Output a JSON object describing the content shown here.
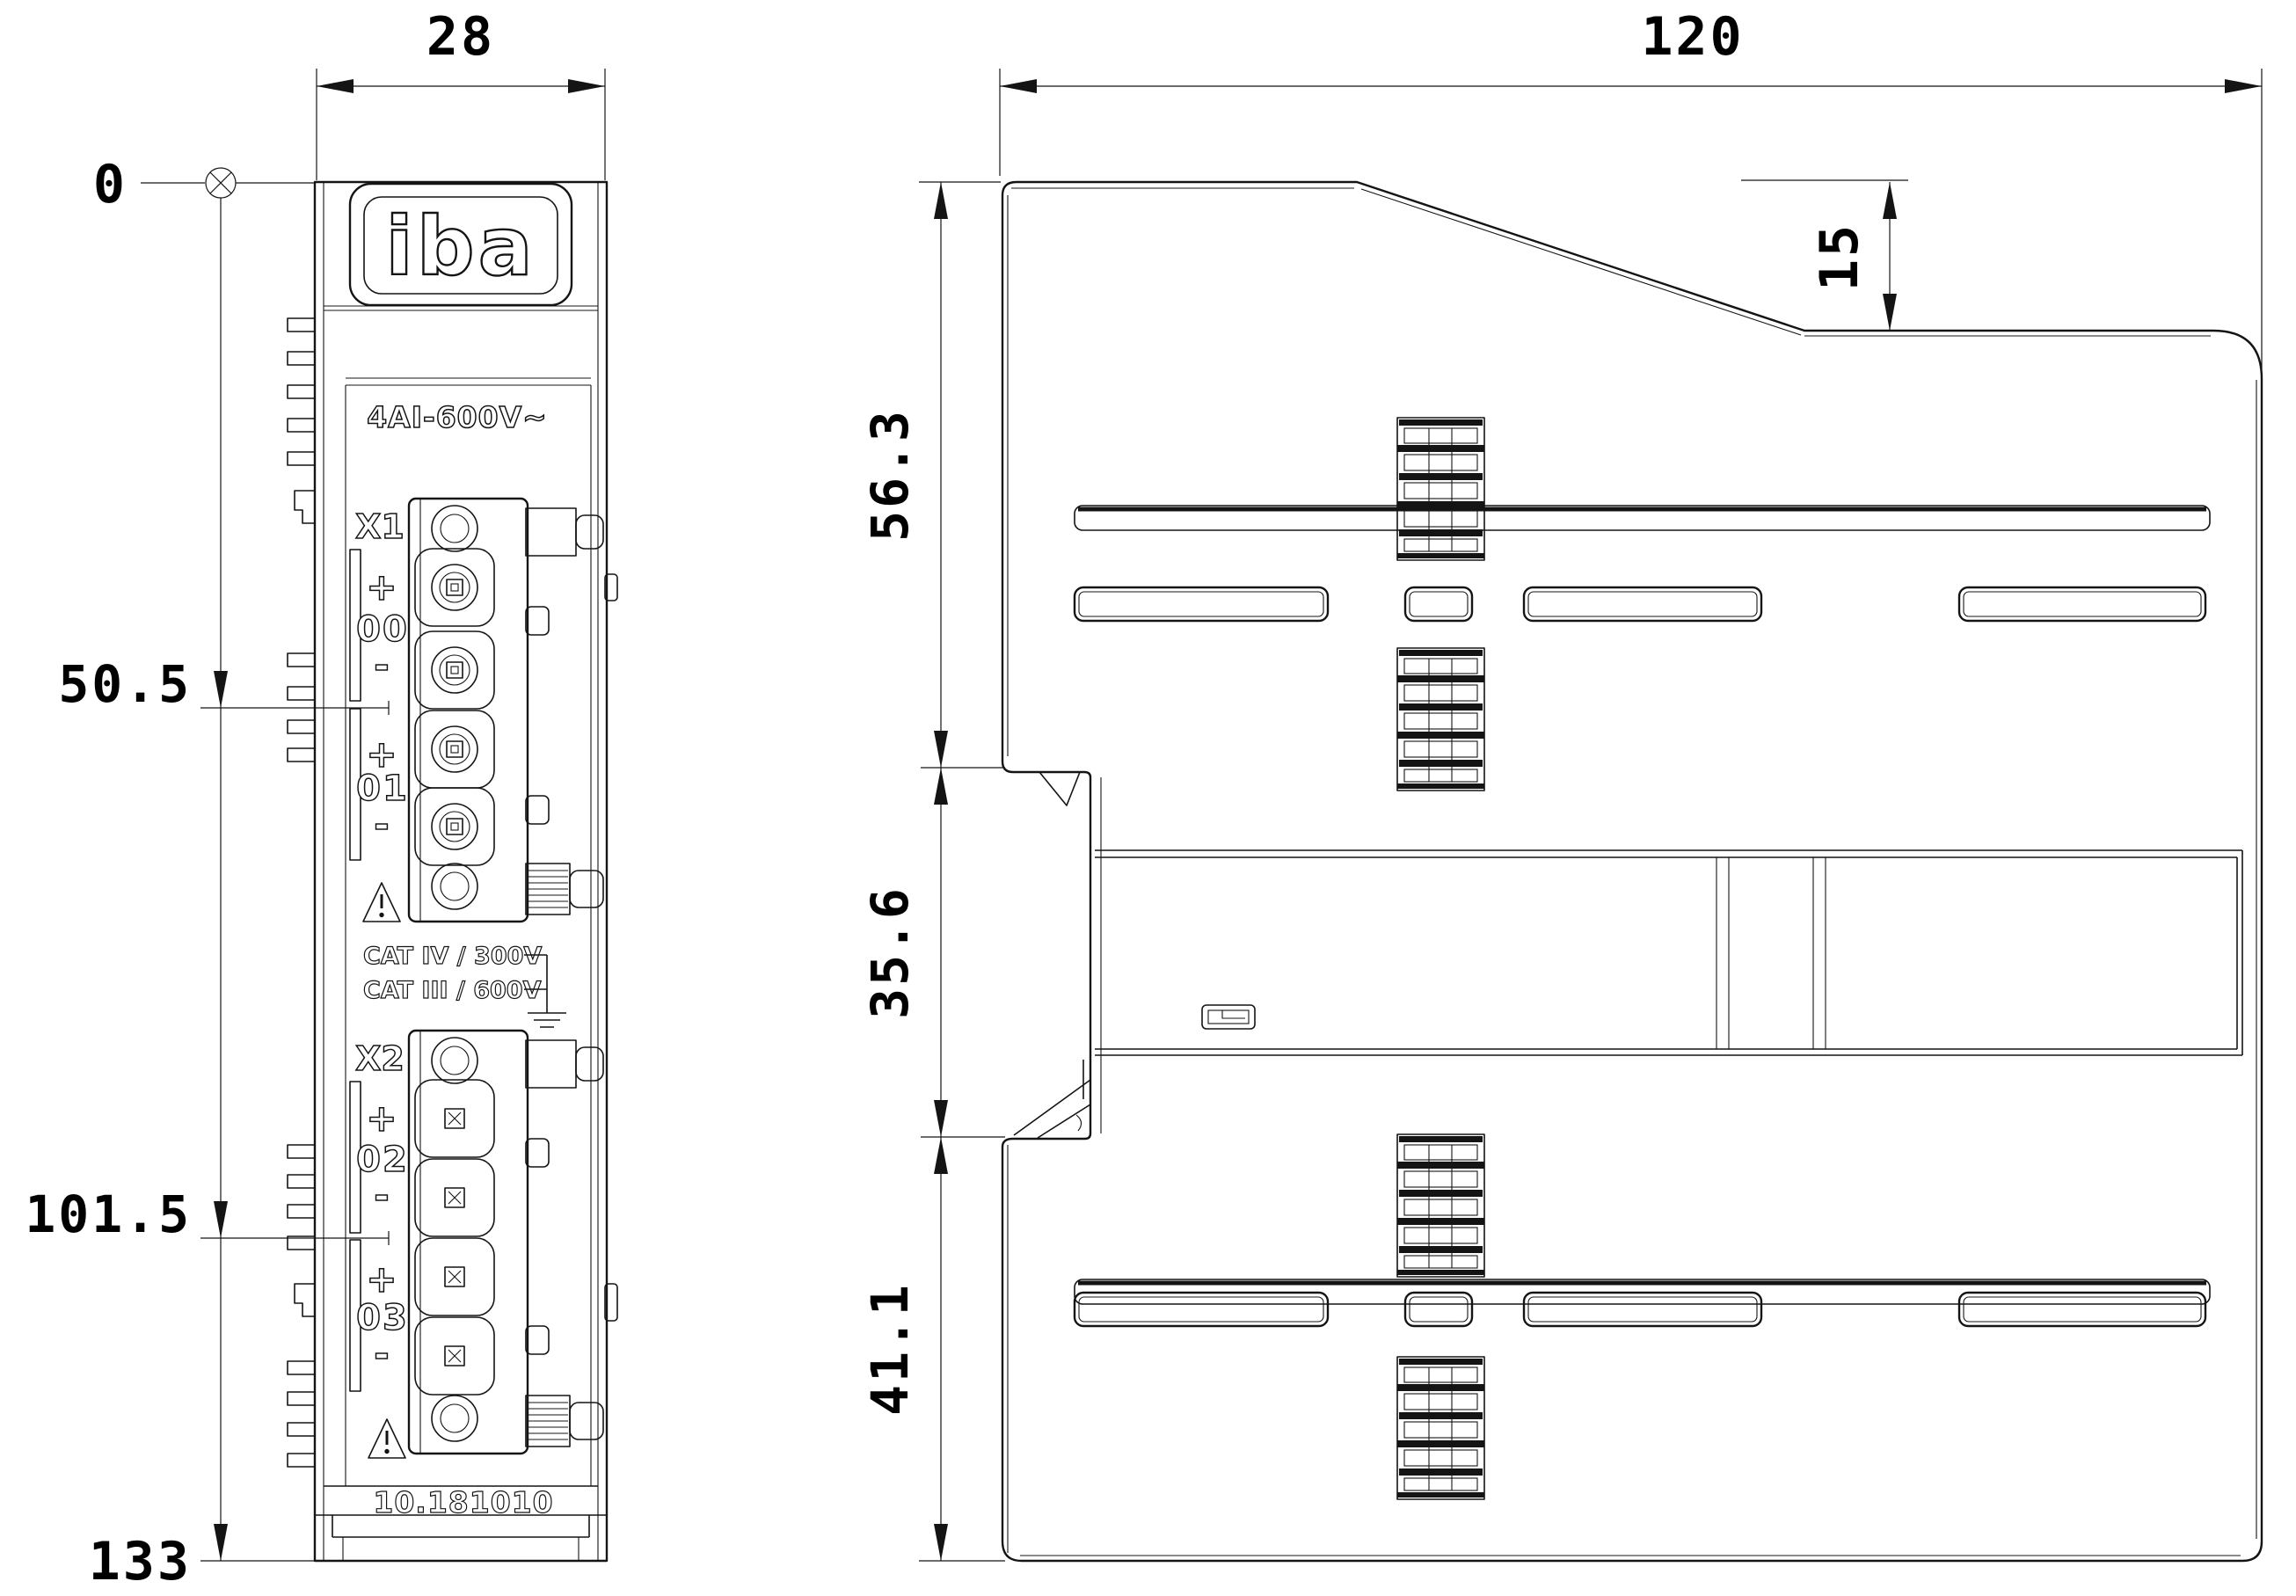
{
  "front_view": {
    "brand_logo": "iba",
    "model": "4AI-600V~",
    "part_number": "10.181010",
    "connector_x1": {
      "label": "X1",
      "channels": [
        {
          "plus": "+",
          "name": "00",
          "minus": "-"
        },
        {
          "plus": "+",
          "name": "01",
          "minus": "-"
        }
      ]
    },
    "connector_x2": {
      "label": "X2",
      "channels": [
        {
          "plus": "+",
          "name": "02",
          "minus": "-"
        },
        {
          "plus": "+",
          "name": "03",
          "minus": "-"
        }
      ]
    },
    "ratings": {
      "line1": "CAT IV / 300V",
      "line2": "CAT III / 600V"
    }
  },
  "dimensions_mm": {
    "width": "28",
    "origin": "0",
    "x1_height": "50.5",
    "x2_height": "101.5",
    "total_height": "133",
    "depth": "120",
    "top_step": "15",
    "top_section": "56.3",
    "mid_section": "35.6",
    "bottom_section": "41.1"
  },
  "icons": {
    "datum_origin": "circle-x-datum",
    "warning": "triangle-exclamation",
    "ground": "earth-ground-symbol"
  }
}
